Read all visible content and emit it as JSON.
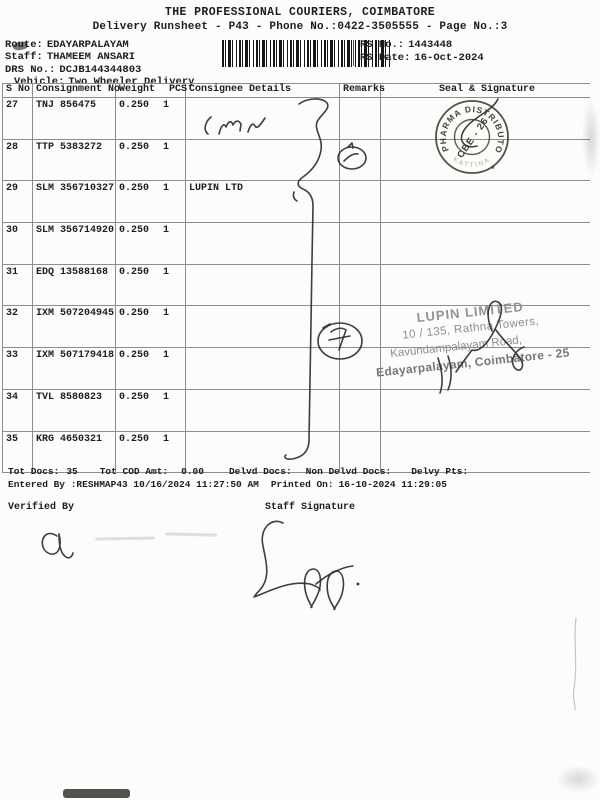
{
  "doc": {
    "title": "THE PROFESSIONAL COURIERS, COIMBATORE",
    "subtitle": "Delivery Runsheet - P43 - Phone No.:0422-3505555 - Page No.:3",
    "route_label": "Route:",
    "route": "EDAYARPALAYAM",
    "staff_label": "Staff:",
    "staff": "THAMEEM ANSARI",
    "drs_label": "DRS No.:",
    "drs": "DCJB144344803",
    "vehicle_label": "Vehicle:",
    "vehicle": "Two Wheeler Delivery",
    "rs_no_label": "RS No.:",
    "rs_no": "1443448",
    "rs_date_label": "RS Date:",
    "rs_date": "16-Oct-2024"
  },
  "table": {
    "headers": {
      "sno": "S No",
      "consignment": "Consignment No",
      "weight": "Weight",
      "pcs": "PCS",
      "consignee": "Consignee Details",
      "remarks": "Remarks",
      "seal": "Seal & Signature"
    },
    "rows": [
      {
        "sno": "27",
        "consignment": "TNJ 856475",
        "weight": "0.250",
        "pcs": "1",
        "consignee": ""
      },
      {
        "sno": "28",
        "consignment": "TTP 5383272",
        "weight": "0.250",
        "pcs": "1",
        "consignee": ""
      },
      {
        "sno": "29",
        "consignment": "SLM 356710327",
        "weight": "0.250",
        "pcs": "1",
        "consignee": "LUPIN LTD"
      },
      {
        "sno": "30",
        "consignment": "SLM 356714920",
        "weight": "0.250",
        "pcs": "1",
        "consignee": ""
      },
      {
        "sno": "31",
        "consignment": "EDQ 13588168",
        "weight": "0.250",
        "pcs": "1",
        "consignee": ""
      },
      {
        "sno": "32",
        "consignment": "IXM 507204945",
        "weight": "0.250",
        "pcs": "1",
        "consignee": ""
      },
      {
        "sno": "33",
        "consignment": "IXM 507179418",
        "weight": "0.250",
        "pcs": "1",
        "consignee": ""
      },
      {
        "sno": "34",
        "consignment": "TVL 8580823",
        "weight": "0.250",
        "pcs": "1",
        "consignee": ""
      },
      {
        "sno": "35",
        "consignment": "KRG 4650321",
        "weight": "0.250",
        "pcs": "1",
        "consignee": ""
      }
    ]
  },
  "totals": {
    "tot_docs_label": "Tot Docs:",
    "tot_docs": "35",
    "tot_cod_label": "Tot COD Amt:",
    "tot_cod": "0.00",
    "delvd_label": "Delvd Docs:",
    "non_delvd_label": "Non Delvd Docs:",
    "delvy_pts_label": "Delvy Pts:",
    "entered_by_label": "Entered By :",
    "entered_by": "RESHMAP43 10/16/2024 11:27:50 AM",
    "printed_on_label": "Printed On:",
    "printed_on": "16-10-2024 11:29:05",
    "verified_by_label": "Verified By",
    "staff_signature_label": "Staff Signature"
  },
  "stamps": {
    "pharma": {
      "ring_text": "PHARMA DISTRIBUTORS",
      "center_text": "CBE - 26",
      "bottom_text": "KATTINA",
      "star": "*",
      "color": "#37332c"
    },
    "lupin": {
      "line1": "LUPIN LIMITED",
      "line2": "10 / 135, Rathna Towers,",
      "line3": "Kavundampalayam Road,",
      "line4": "Edayarpalayam, Coimbatore - 25",
      "color": "#8d8d8d"
    }
  },
  "handwriting_color": "#2f2e2c"
}
